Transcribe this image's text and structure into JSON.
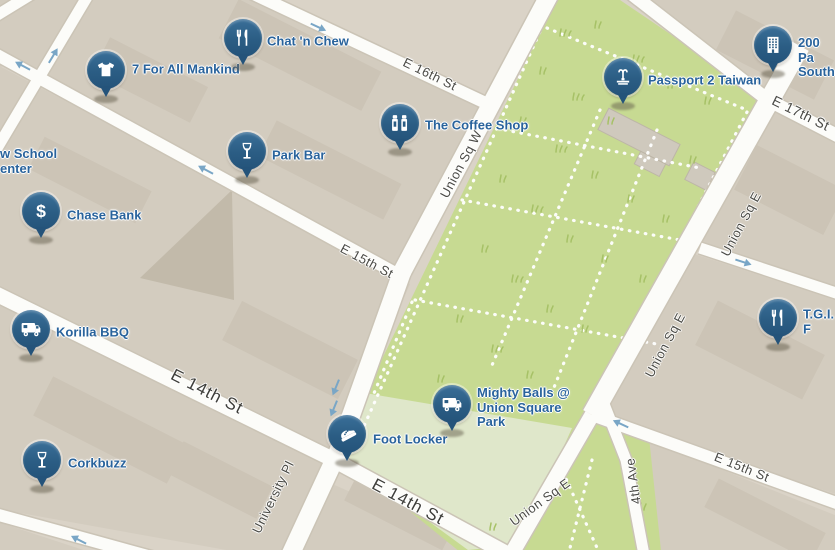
{
  "map": {
    "venues": [
      {
        "label": "7 For All Mankind",
        "icon": "tshirt-icon"
      },
      {
        "label": "Chat 'n Chew",
        "icon": "utensils-icon"
      },
      {
        "label": "The Coffee Shop",
        "icon": "shakers-icon"
      },
      {
        "label": "Park Bar",
        "icon": "wine-glass-icon"
      },
      {
        "label": "Chase Bank",
        "icon": "dollar-icon"
      },
      {
        "label": "Korilla BBQ",
        "icon": "food-truck-icon"
      },
      {
        "label": "Corkbuzz",
        "icon": "wine-glass-icon"
      },
      {
        "label": "Foot Locker",
        "icon": "sneaker-icon"
      },
      {
        "label": "Mighty Balls @\nUnion Square\nPark",
        "icon": "food-truck-icon"
      },
      {
        "label": "Passport 2 Taiwan",
        "icon": "fountain-icon"
      },
      {
        "label": "200 Pa\nSouth",
        "icon": "building-icon"
      },
      {
        "label": "T.G.I. F",
        "icon": "utensils-icon"
      }
    ],
    "street_labels": [
      {
        "text": "E 16th St"
      },
      {
        "text": "E 15th St"
      },
      {
        "text": "Union Sq W"
      },
      {
        "text": "E 17th St"
      },
      {
        "text": "Union Sq E"
      },
      {
        "text": "Union Sq E"
      },
      {
        "text": "E 15th St"
      },
      {
        "text": "4th Ave"
      },
      {
        "text": "E 14th St"
      },
      {
        "text": "E 14th St"
      },
      {
        "text": "University Pl"
      },
      {
        "text": "Union Sq E"
      }
    ],
    "place_fragments": {
      "school": "w School\nenter"
    },
    "icon_glyphs": {
      "dollar": "$"
    },
    "colors": {
      "pin_blue": "#2b5d84",
      "venue_label_blue": "#29639c",
      "street_fill": "#fcfcf9",
      "block_beige": "#d3ccbf",
      "park_green": "#c7da92",
      "plaza_green": "#dfe7ca",
      "arrow_blue": "#79a6c6"
    }
  }
}
